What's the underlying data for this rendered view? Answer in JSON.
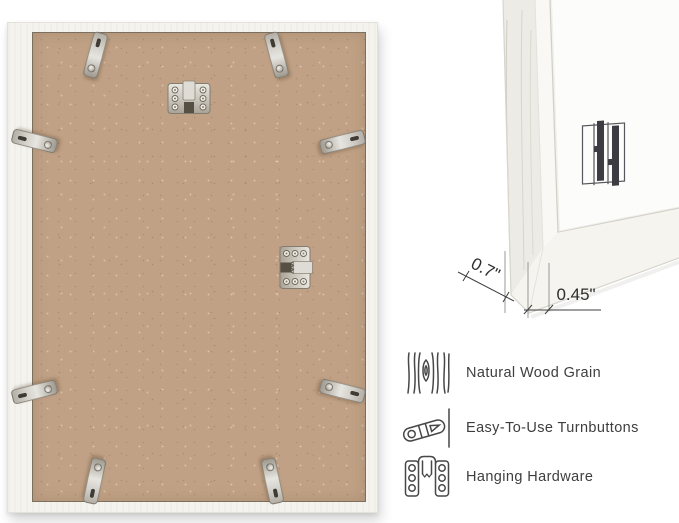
{
  "back_view": {
    "hardware": {
      "turnbutton_icon": "turnbutton",
      "hanger_top_icon": "sawtooth-hanger-horizontal",
      "hanger_side_icon": "sawtooth-hanger-vertical"
    }
  },
  "corner_view": {
    "logo_icon": "brand-bars-mark",
    "dimensions": [
      {
        "id": "frame-depth",
        "label": "0.7\""
      },
      {
        "id": "frame-face-width",
        "label": "0.45\""
      }
    ]
  },
  "features": [
    {
      "icon": "wood-grain-icon",
      "label": "Natural Wood Grain"
    },
    {
      "icon": "turnbutton-icon",
      "label": "Easy-To-Use Turnbuttons"
    },
    {
      "icon": "hanging-hardware-icon",
      "label": "Hanging Hardware"
    }
  ],
  "colors": {
    "background": "#ffffff",
    "mdf_backing": "#c0a185",
    "frame_white": "#f4f3ee",
    "metal_hardware": "#cfccc4",
    "annotation_text": "#2e2e2e",
    "feature_text": "#3e3e3e",
    "logo_mark": "#3c3c42"
  }
}
